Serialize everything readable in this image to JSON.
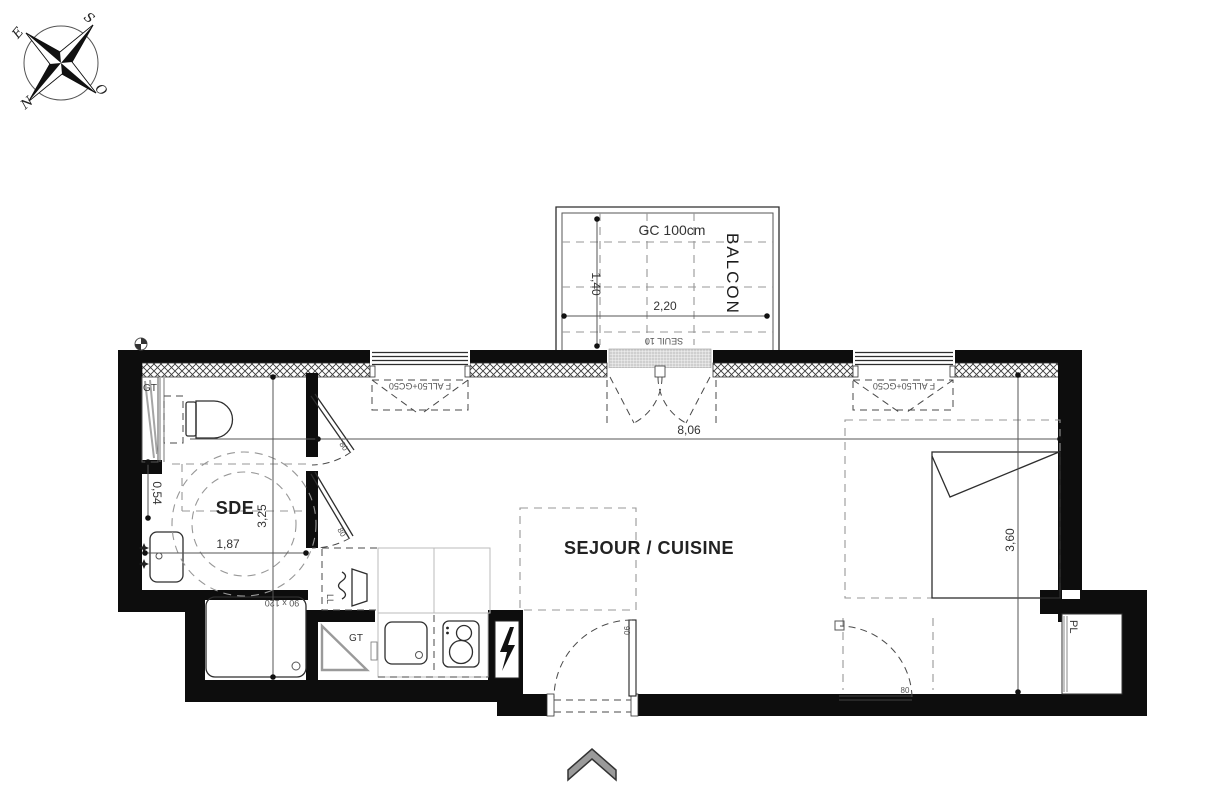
{
  "compass": {
    "north": "N",
    "south": "S",
    "east": "E",
    "west": "O"
  },
  "balcony": {
    "name": "BALCON",
    "guardrail_note": "GC 100cm",
    "threshold_note": "SEUIL 10",
    "width_dim": "2,20",
    "depth_dim": "1,40"
  },
  "rooms": {
    "bathroom": "SDE",
    "living_kitchen": "SEJOUR / CUISINE",
    "closet": "PL"
  },
  "windows": {
    "left_label": "F ALL50+GC50",
    "right_label": "F ALL50+GC50"
  },
  "dimensions": {
    "living_width": "8,06",
    "living_depth": "3,60",
    "bathroom_width": "1,87",
    "bathroom_length": "3,25",
    "basin_offset": "0,54",
    "shower_size": "90 x 120"
  },
  "doors": {
    "bathroom_door_1": "80",
    "bathroom_door_2": "80",
    "future_door": "80",
    "entrance_door": "90"
  },
  "services": {
    "duct_top": "GT",
    "duct_kitchen": "GT",
    "washer": "LL"
  }
}
